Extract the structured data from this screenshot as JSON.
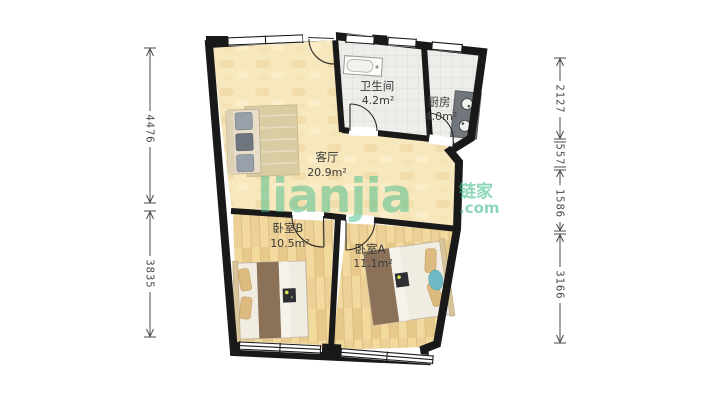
{
  "watermark": {
    "brand": "lianjia",
    "brand_cn": "链家",
    "suffix": ".com"
  },
  "rooms": [
    {
      "id": "living",
      "name": "客厅",
      "area": "20.9m²"
    },
    {
      "id": "bathroom",
      "name": "卫生间",
      "area": "4.2m²"
    },
    {
      "id": "kitchen",
      "name": "厨房",
      "area": "4.0m²"
    },
    {
      "id": "bedroomB",
      "name": "卧室B",
      "area": "10.5m²"
    },
    {
      "id": "bedroomA",
      "name": "卧室A",
      "area": "11.1m²"
    }
  ],
  "dimensions_mm": {
    "left": [
      "4476",
      "3835"
    ],
    "right": [
      "2127",
      "557",
      "1586",
      "3166"
    ]
  },
  "colors": {
    "wall": "#191919",
    "floor_living": "#F7E7BD",
    "floor_wood": "#F2D99E",
    "floor_tile": "#EDEDEA",
    "watermark_green": "#46BE8C",
    "dimension_text": "#4A4A4A"
  }
}
